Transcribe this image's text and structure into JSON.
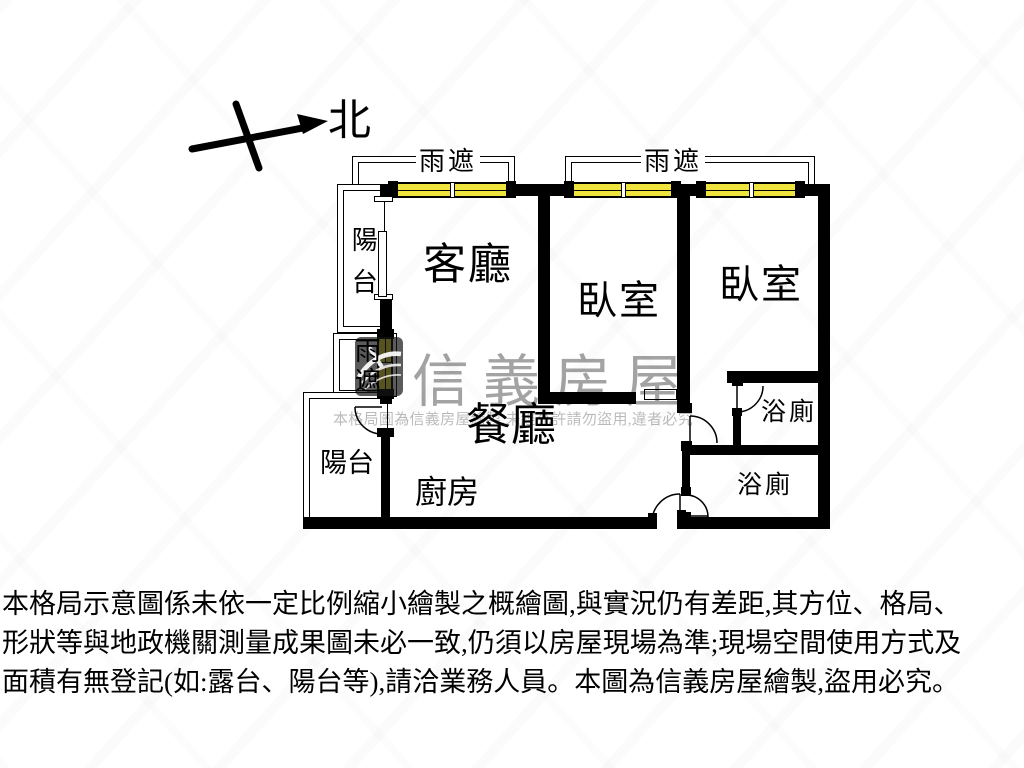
{
  "plan": {
    "north": "北",
    "labels": {
      "canopy_top_left": "雨遮",
      "canopy_top_right": "雨遮",
      "canopy_side": "雨遮",
      "balcony_upper": "陽台",
      "balcony_lower": "陽台",
      "living_room": "客廳",
      "bedroom_left": "臥室",
      "bedroom_right": "臥室",
      "dining_room": "餐廳",
      "kitchen": "廚房",
      "bathroom_upper": "浴廁",
      "bathroom_lower": "浴廁"
    },
    "window_color": "#EFE33E",
    "wall_color": "#000000"
  },
  "watermark": {
    "brand": "信義房屋",
    "notice": "本格局圖為信義房屋繪製,未經允許請勿盜用,違者必究"
  },
  "disclaimer": {
    "line1": "本格局示意圖係未依一定比例縮小繪製之概繪圖,與實況仍有差距,其方位、格局、",
    "line2": "形狀等與地政機關測量成果圖未必一致,仍須以房屋現場為準;現場空間使用方式及",
    "line3": "面積有無登記(如:露台、陽台等),請洽業務人員。本圖為信義房屋繪製,盜用必究。"
  }
}
